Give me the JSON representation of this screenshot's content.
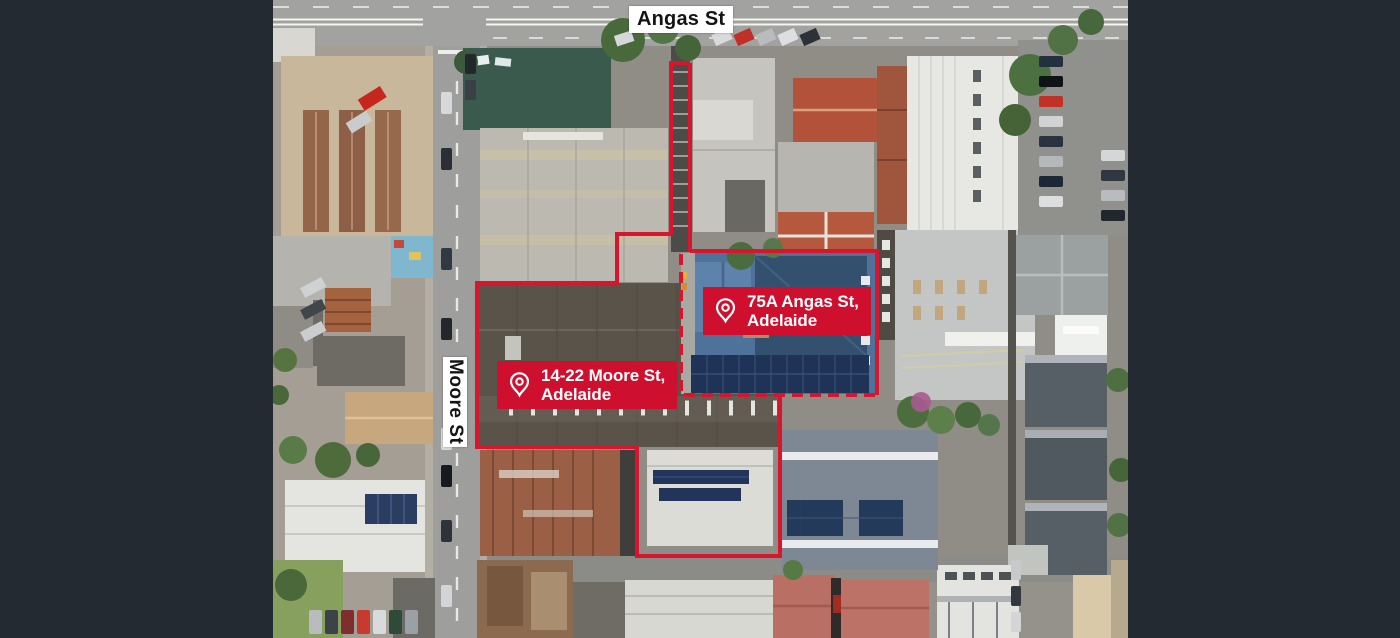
{
  "image_type": "aerial-property-photo",
  "colors": {
    "accent_red": "#d8152f",
    "badge_red": "#cf0f2e",
    "badge_text": "#ffffff",
    "street_label_bg": "#ffffff",
    "street_label_text": "#141414",
    "letterbox": "#242a31"
  },
  "street_labels": {
    "horizontal": "Angas St",
    "vertical": "Moore St"
  },
  "badges": {
    "angas": {
      "line1": "75A Angas St,",
      "line2": "Adelaide"
    },
    "moore": {
      "line1": "14-22 Moore St,",
      "line2": "Adelaide"
    }
  },
  "icons": {
    "badge_pin": "location-pin-outline"
  }
}
